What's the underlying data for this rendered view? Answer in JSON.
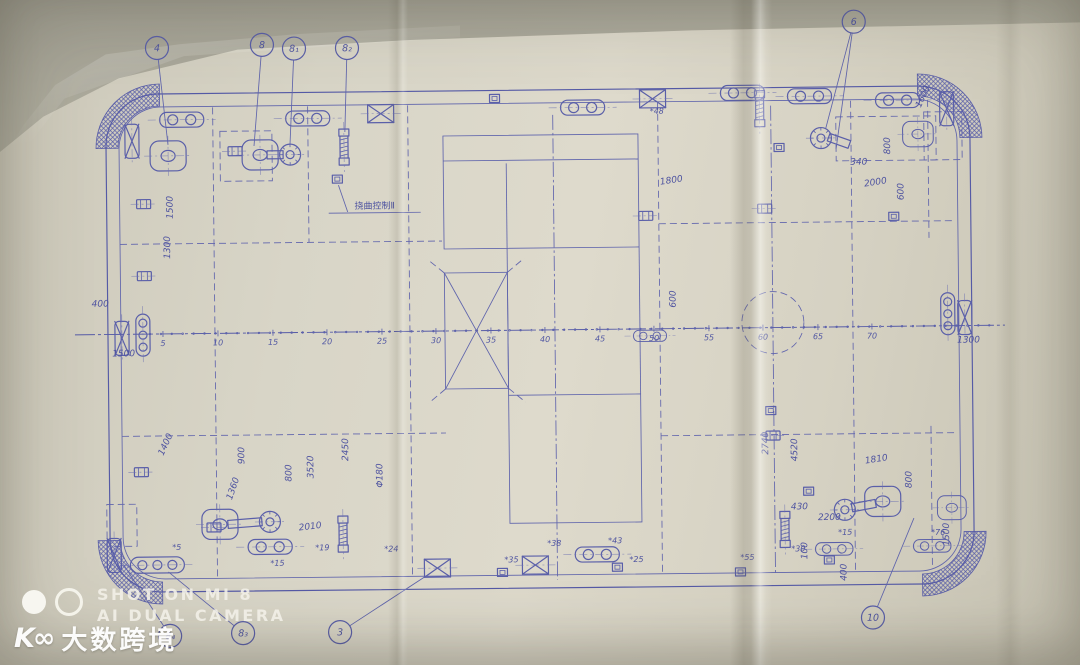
{
  "photo": {
    "watermark_camera": {
      "line1": "SHOT ON MI 8",
      "line2": "AI DUAL CAMERA"
    },
    "watermark_brand": {
      "logo": "K∞",
      "text": "大数跨境"
    }
  },
  "drawing": {
    "ink_color": "#5a5fa9",
    "paper_color": "#d8d5c7",
    "annotation": {
      "text": "挠曲控制Ⅱ",
      "x": 376,
      "y": 207
    },
    "boundary": {
      "outer": [
        108,
        90,
        864,
        498,
        52
      ],
      "inner": [
        121,
        103,
        838,
        472,
        42
      ]
    },
    "hatch_corners": {
      "r1": 42,
      "r2": 64,
      "arcs": [
        [
          162,
          144,
          180,
          270
        ],
        [
          920,
          142,
          270,
          360
        ],
        [
          920,
          536,
          0,
          90
        ],
        [
          160,
          536,
          90,
          180
        ]
      ]
    },
    "centerline": {
      "y": 330,
      "x1": 75,
      "x2": 1005
    },
    "frames": [
      [
        "5",
        163
      ],
      [
        "10",
        218
      ],
      [
        "15",
        273
      ],
      [
        "20",
        327
      ],
      [
        "25",
        382
      ],
      [
        "30",
        436
      ],
      [
        "35",
        491
      ],
      [
        "40",
        545
      ],
      [
        "45",
        600
      ],
      [
        "50",
        654
      ],
      [
        "55",
        709
      ],
      [
        "60",
        763
      ],
      [
        "65",
        818
      ],
      [
        "70",
        872
      ]
    ],
    "structures": {
      "rectA": [
        445,
        135,
        195,
        113
      ],
      "xbox": [
        445,
        272,
        63,
        116
      ],
      "rectB": [
        508,
        395,
        132,
        128
      ]
    },
    "circle_dashed": [
      773,
      325,
      31
    ],
    "dash_rects": [
      [
        222,
        128,
        52,
        50
      ],
      [
        105,
        500,
        30,
        42
      ],
      [
        838,
        120,
        100,
        44
      ],
      [
        926,
        116,
        38,
        48
      ]
    ],
    "lines": [
      [
        215,
        104,
        215,
        573,
        "d"
      ],
      [
        310,
        104,
        310,
        240,
        "d"
      ],
      [
        410,
        104,
        410,
        573,
        "d"
      ],
      [
        555,
        115,
        555,
        580,
        "dd"
      ],
      [
        660,
        104,
        660,
        573,
        "d"
      ],
      [
        773,
        108,
        773,
        575,
        "dd"
      ],
      [
        853,
        104,
        853,
        573,
        "d"
      ],
      [
        930,
        104,
        930,
        242,
        "d"
      ],
      [
        930,
        430,
        930,
        573,
        "d"
      ],
      [
        121,
        240,
        443,
        240,
        "d"
      ],
      [
        660,
        225,
        956,
        225,
        "d"
      ],
      [
        121,
        432,
        445,
        432,
        "d"
      ],
      [
        660,
        437,
        956,
        437,
        "d"
      ],
      [
        508,
        163,
        508,
        395,
        "s"
      ],
      [
        445,
        160,
        640,
        160,
        "s"
      ],
      [
        640,
        248,
        640,
        395,
        "s"
      ],
      [
        445,
        272,
        428,
        258,
        "d"
      ],
      [
        508,
        272,
        525,
        258,
        "d"
      ],
      [
        445,
        388,
        428,
        402,
        "d"
      ],
      [
        508,
        388,
        525,
        402,
        "d"
      ],
      [
        330,
        211,
        422,
        211,
        "s"
      ],
      [
        340,
        183,
        349,
        210,
        "s"
      ]
    ],
    "fittings": [
      {
        "t": "cleat2",
        "x": 184,
        "y": 116
      },
      {
        "t": "cleat2",
        "x": 310,
        "y": 116
      },
      {
        "t": "cleat2",
        "x": 585,
        "y": 108
      },
      {
        "t": "cleat2",
        "x": 745,
        "y": 95
      },
      {
        "t": "cleat2",
        "x": 812,
        "y": 99
      },
      {
        "t": "cleat2",
        "x": 900,
        "y": 104
      },
      {
        "t": "cleat2",
        "x": 650,
        "y": 337,
        "s": 0.75
      },
      {
        "t": "cleat2",
        "x": 268,
        "y": 544
      },
      {
        "t": "cleat2",
        "x": 595,
        "y": 555
      },
      {
        "t": "cleat2",
        "x": 832,
        "y": 552,
        "s": 0.85
      },
      {
        "t": "cleat2",
        "x": 930,
        "y": 550,
        "s": 0.85
      },
      {
        "t": "fairlead3",
        "x": 155,
        "y": 561
      },
      {
        "t": "rollerV3",
        "x": 143,
        "y": 331
      },
      {
        "t": "rollerV3",
        "x": 948,
        "y": 318
      },
      {
        "t": "bollardX",
        "x": 134,
        "y": 137
      },
      {
        "t": "bollardX",
        "x": 122,
        "y": 334
      },
      {
        "t": "bollardX",
        "x": 965,
        "y": 322
      },
      {
        "t": "bollardX",
        "x": 112,
        "y": 551
      },
      {
        "t": "bollardX",
        "x": 949,
        "y": 113
      },
      {
        "t": "xpad",
        "x": 383,
        "y": 112
      },
      {
        "t": "xpad",
        "x": 655,
        "y": 100
      },
      {
        "t": "xpad",
        "x": 435,
        "y": 567
      },
      {
        "t": "xpad",
        "x": 533,
        "y": 565
      },
      {
        "t": "chock",
        "x": 170,
        "y": 152
      },
      {
        "t": "chock",
        "x": 262,
        "y": 152
      },
      {
        "t": "chock",
        "x": 218,
        "y": 521
      },
      {
        "t": "chock",
        "x": 881,
        "y": 505
      },
      {
        "t": "chock",
        "x": 950,
        "y": 512,
        "s": 0.8
      },
      {
        "t": "chock",
        "x": 920,
        "y": 138,
        "s": 0.85
      },
      {
        "t": "winch",
        "x": 292,
        "y": 152
      },
      {
        "t": "winch",
        "x": 823,
        "y": 141
      },
      {
        "t": "winch",
        "x": 268,
        "y": 519
      },
      {
        "t": "winch",
        "x": 843,
        "y": 513
      },
      {
        "t": "screwV",
        "x": 346,
        "y": 145
      },
      {
        "t": "screwV",
        "x": 762,
        "y": 111
      },
      {
        "t": "screwV",
        "x": 341,
        "y": 532
      },
      {
        "t": "screwV",
        "x": 783,
        "y": 532
      },
      {
        "t": "eyeplate",
        "x": 145,
        "y": 200
      },
      {
        "t": "eyeplate",
        "x": 145,
        "y": 272
      },
      {
        "t": "eyeplate",
        "x": 140,
        "y": 468
      },
      {
        "t": "eyeplate",
        "x": 766,
        "y": 211
      },
      {
        "t": "eyeplate",
        "x": 647,
        "y": 217
      },
      {
        "t": "eyeplate",
        "x": 772,
        "y": 438
      },
      {
        "t": "eyeplate",
        "x": 212,
        "y": 524
      },
      {
        "t": "eyeplate",
        "x": 237,
        "y": 148
      },
      {
        "t": "smallSq",
        "x": 497,
        "y": 98
      },
      {
        "t": "smallSq",
        "x": 781,
        "y": 150
      },
      {
        "t": "smallSq",
        "x": 895,
        "y": 220
      },
      {
        "t": "smallSq",
        "x": 770,
        "y": 413
      },
      {
        "t": "smallSq",
        "x": 807,
        "y": 494
      },
      {
        "t": "smallSq",
        "x": 500,
        "y": 572
      },
      {
        "t": "smallSq",
        "x": 615,
        "y": 568
      },
      {
        "t": "smallSq",
        "x": 738,
        "y": 574
      },
      {
        "t": "smallSq",
        "x": 827,
        "y": 563
      },
      {
        "t": "smallSq",
        "x": 339,
        "y": 177
      }
    ],
    "bars": [
      [
        277,
        152,
        16,
        0
      ],
      [
        841,
        144,
        22,
        20
      ],
      [
        243,
        520,
        34,
        -4
      ],
      [
        862,
        509,
        24,
        -10
      ]
    ],
    "dimensions": [
      {
        "t": "400",
        "x": 92,
        "y": 302,
        "r": 0
      },
      {
        "t": "1500",
        "x": 112,
        "y": 352,
        "r": 0
      },
      {
        "t": "1500",
        "x": 174,
        "y": 215,
        "r": -90
      },
      {
        "t": "1300",
        "x": 171,
        "y": 255,
        "r": -90
      },
      {
        "t": "1400",
        "x": 162,
        "y": 452,
        "r": -65
      },
      {
        "t": "900",
        "x": 243,
        "y": 461,
        "r": -90
      },
      {
        "t": "800",
        "x": 290,
        "y": 479,
        "r": -90
      },
      {
        "t": "3520",
        "x": 312,
        "y": 476,
        "r": -90
      },
      {
        "t": "2450",
        "x": 347,
        "y": 459,
        "r": -90
      },
      {
        "t": "Φ180",
        "x": 381,
        "y": 486,
        "r": -90
      },
      {
        "t": "2010",
        "x": 297,
        "y": 528,
        "r": -6
      },
      {
        "t": "1360",
        "x": 230,
        "y": 497,
        "r": -70
      },
      {
        "t": "1800",
        "x": 662,
        "y": 186,
        "r": -8
      },
      {
        "t": "600",
        "x": 676,
        "y": 309,
        "r": -90
      },
      {
        "t": "340",
        "x": 852,
        "y": 168,
        "r": 0
      },
      {
        "t": "800",
        "x": 892,
        "y": 158,
        "r": -90
      },
      {
        "t": "2000",
        "x": 866,
        "y": 190,
        "r": -8
      },
      {
        "t": "600",
        "x": 905,
        "y": 204,
        "r": -90
      },
      {
        "t": "1600",
        "x": 923,
        "y": 112,
        "r": -65
      },
      {
        "t": "1300",
        "x": 957,
        "y": 347,
        "r": 0
      },
      {
        "t": "2740",
        "x": 767,
        "y": 457,
        "r": -90
      },
      {
        "t": "4520",
        "x": 796,
        "y": 464,
        "r": -90
      },
      {
        "t": "1810",
        "x": 864,
        "y": 467,
        "r": -8
      },
      {
        "t": "800",
        "x": 910,
        "y": 492,
        "r": -90
      },
      {
        "t": "430",
        "x": 789,
        "y": 512,
        "r": 0
      },
      {
        "t": "2200",
        "x": 816,
        "y": 523,
        "r": 0
      },
      {
        "t": "100",
        "x": 805,
        "y": 562,
        "r": -90
      },
      {
        "t": "1500",
        "x": 947,
        "y": 550,
        "r": -90
      },
      {
        "t": "400",
        "x": 844,
        "y": 584,
        "r": -90
      }
    ],
    "stations": [
      {
        "t": "*48",
        "x": 652,
        "y": 115
      },
      {
        "t": "*5",
        "x": 170,
        "y": 546
      },
      {
        "t": "*15",
        "x": 268,
        "y": 563
      },
      {
        "t": "*19",
        "x": 313,
        "y": 548
      },
      {
        "t": "*24",
        "x": 382,
        "y": 550
      },
      {
        "t": "*35",
        "x": 502,
        "y": 562
      },
      {
        "t": "*38",
        "x": 545,
        "y": 546
      },
      {
        "t": "*43",
        "x": 606,
        "y": 544
      },
      {
        "t": "*25",
        "x": 627,
        "y": 563
      },
      {
        "t": "*55",
        "x": 738,
        "y": 562
      },
      {
        "t": "*15",
        "x": 836,
        "y": 538
      },
      {
        "t": "*30",
        "x": 789,
        "y": 554
      },
      {
        "t": "*76",
        "x": 929,
        "y": 539
      }
    ],
    "balloons": [
      {
        "l": "4",
        "x": 160,
        "y": 44,
        "t": [
          [
            170,
            141
          ]
        ]
      },
      {
        "l": "8",
        "x": 265,
        "y": 42,
        "t": [
          [
            256,
            143
          ]
        ]
      },
      {
        "l": "8₁",
        "x": 297,
        "y": 46,
        "t": [
          [
            292,
            142
          ]
        ]
      },
      {
        "l": "8₂",
        "x": 350,
        "y": 46,
        "t": [
          [
            347,
            130
          ]
        ]
      },
      {
        "l": "6",
        "x": 857,
        "y": 25,
        "t": [
          [
            828,
            131
          ],
          [
            838,
            152
          ]
        ]
      },
      {
        "l": "3",
        "x": 337,
        "y": 630,
        "t": [
          [
            428,
            572
          ]
        ]
      },
      {
        "l": "8₃",
        "x": 240,
        "y": 630,
        "t": [
          [
            166,
            568
          ]
        ]
      },
      {
        "l": "8₄",
        "x": 167,
        "y": 632,
        "t": [
          [
            121,
            560
          ]
        ]
      },
      {
        "l": "10",
        "x": 870,
        "y": 621,
        "t": [
          [
            912,
            522
          ]
        ]
      }
    ]
  }
}
